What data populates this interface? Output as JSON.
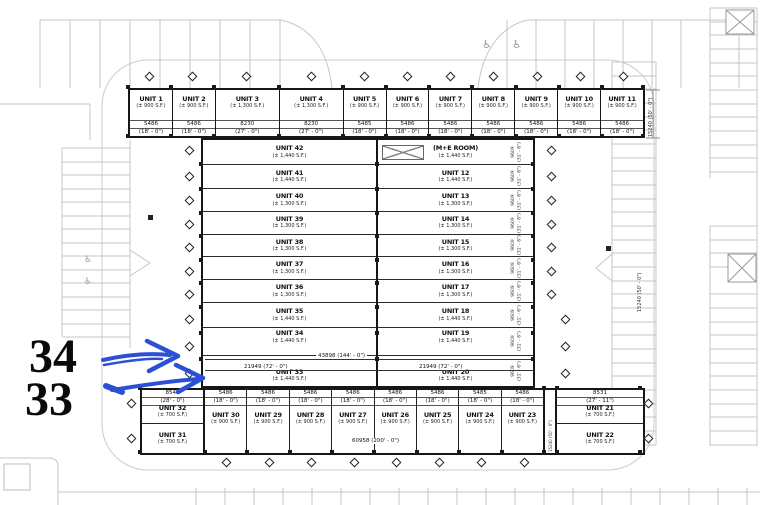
{
  "plan": {
    "top_units": [
      {
        "name": "UNIT 1",
        "area": "(± 900 S.F.)",
        "w": "5486",
        "ft": "(18' - 0\")"
      },
      {
        "name": "UNIT 2",
        "area": "(± 900 S.F.)",
        "w": "5486",
        "ft": "(18' - 0\")"
      },
      {
        "name": "UNIT 3",
        "area": "(± 1,300 S.F.)",
        "w": "8230",
        "ft": "(27' - 0\")"
      },
      {
        "name": "UNIT 4",
        "area": "(± 1,300 S.F.)",
        "w": "8230",
        "ft": "(27' - 0\")"
      },
      {
        "name": "UNIT 5",
        "area": "(± 900 S.F.)",
        "w": "5485",
        "ft": "(18' - 0\")"
      },
      {
        "name": "UNIT 6",
        "area": "(± 900 S.F.)",
        "w": "5486",
        "ft": "(18' - 0\")"
      },
      {
        "name": "UNIT 7",
        "area": "(± 900 S.F.)",
        "w": "5486",
        "ft": "(18' - 0\")"
      },
      {
        "name": "UNIT 8",
        "area": "(± 900 S.F.)",
        "w": "5486",
        "ft": "(18' - 0\")"
      },
      {
        "name": "UNIT 9",
        "area": "(± 900 S.F.)",
        "w": "5486",
        "ft": "(18' - 0\")"
      },
      {
        "name": "UNIT 10",
        "area": "(± 900 S.F.)",
        "w": "5486",
        "ft": "(18' - 0\")"
      },
      {
        "name": "UNIT 11",
        "area": "(± 900 S.F.)",
        "w": "5486",
        "ft": "(18' - 0\")"
      }
    ],
    "left_units": [
      {
        "name": "UNIT 42",
        "area": "(± 1,440 S.F.)"
      },
      {
        "name": "UNIT 41",
        "area": "(± 1,440 S.F.)"
      },
      {
        "name": "UNIT 40",
        "area": "(± 1,300 S.F.)"
      },
      {
        "name": "UNIT 39",
        "area": "(± 1,300 S.F.)"
      },
      {
        "name": "UNIT 38",
        "area": "(± 1,300 S.F.)"
      },
      {
        "name": "UNIT 37",
        "area": "(± 1,300 S.F.)"
      },
      {
        "name": "UNIT 36",
        "area": "(± 1,300 S.F.)"
      },
      {
        "name": "UNIT 35",
        "area": "(± 1,440 S.F.)"
      },
      {
        "name": "UNIT 34",
        "area": "(± 1,440 S.F.)"
      },
      {
        "name": "UNIT 33",
        "area": "(± 1,440 S.F.)"
      }
    ],
    "right_units": [
      {
        "name": "(M+E ROOM)",
        "area": "(± 1,440 S.F.)",
        "d": "9609",
        "dft": "(31' - 6\")"
      },
      {
        "name": "UNIT 12",
        "area": "(± 1,440 S.F.)",
        "d": "9609",
        "dft": "(31' - 6\")"
      },
      {
        "name": "UNIT 13",
        "area": "(± 1,300 S.F.)",
        "d": "9609",
        "dft": "(31' - 6\")"
      },
      {
        "name": "UNIT 14",
        "area": "(± 1,300 S.F.)",
        "d": "9609",
        "dft": "(31' - 6\")"
      },
      {
        "name": "UNIT 15",
        "area": "(± 1,300 S.F.)",
        "d": "9609",
        "dft": "(31' - 6\")"
      },
      {
        "name": "UNIT 16",
        "area": "(± 1,300 S.F.)",
        "d": "9609",
        "dft": "(31' - 6\")"
      },
      {
        "name": "UNIT 17",
        "area": "(± 1,300 S.F.)",
        "d": "9609",
        "dft": "(31' - 6\")"
      },
      {
        "name": "UNIT 18",
        "area": "(± 1,440 S.F.)",
        "d": "9609",
        "dft": "(31' - 6\")"
      },
      {
        "name": "UNIT 19",
        "area": "(± 1,440 S.F.)",
        "d": "9609",
        "dft": "(31' - 6\")"
      },
      {
        "name": "UNIT 20",
        "area": "(± 1,440 S.F.)",
        "d": "9609",
        "dft": "(31' - 6\")"
      }
    ],
    "bottom_units": [
      {
        "name": "UNIT 30",
        "area": "(± 900 S.F.)",
        "w": "5486",
        "ft": "(18' - 0\")"
      },
      {
        "name": "UNIT 29",
        "area": "(± 900 S.F.)",
        "w": "5486",
        "ft": "(18' - 0\")"
      },
      {
        "name": "UNIT 28",
        "area": "(± 900 S.F.)",
        "w": "5486",
        "ft": "(18' - 0\")"
      },
      {
        "name": "UNIT 27",
        "area": "(± 900 S.F.)",
        "w": "5486",
        "ft": "(18' - 0\")"
      },
      {
        "name": "UNIT 26",
        "area": "(± 900 S.F.)",
        "w": "5486",
        "ft": "(18' - 0\")"
      },
      {
        "name": "UNIT 25",
        "area": "(± 900 S.F.)",
        "w": "5486",
        "ft": "(18' - 0\")"
      },
      {
        "name": "UNIT 24",
        "area": "(± 900 S.F.)",
        "w": "5485",
        "ft": "(18' - 0\")"
      },
      {
        "name": "UNIT 23",
        "area": "(± 900 S.F.)",
        "w": "5486",
        "ft": "(18' - 0\")"
      }
    ],
    "west": {
      "w": "8546",
      "ft": "(28' - 0\")",
      "u32_name": "UNIT 32",
      "u32_area": "(± 700 S.F.)",
      "u31_name": "UNIT 31",
      "u31_area": "(± 700 S.F.)"
    },
    "east": {
      "w": "8531",
      "ft": "(27' - 11\")",
      "u21_name": "UNIT 21",
      "u21_area": "(± 700 S.F.)",
      "u22_name": "UNIT 22",
      "u22_area": "(± 700 S.F.)"
    },
    "dims": {
      "total": "43898 (144' - 0\")",
      "half_left": "21949 (72' - 0\")",
      "half_right": "21949 (72' - 0\")",
      "bottom": "60958 (200' - 0\")",
      "depth_right": "15240 (50' - 0\")",
      "depth_parking": "15240 (50' - 0\")",
      "depth_corridor": "15240 (50' - 0\")"
    }
  },
  "annotations": {
    "label_34": "34",
    "label_33": "33",
    "arrow_color": "#2b50d6"
  },
  "icons": {
    "handicap": "♿"
  }
}
